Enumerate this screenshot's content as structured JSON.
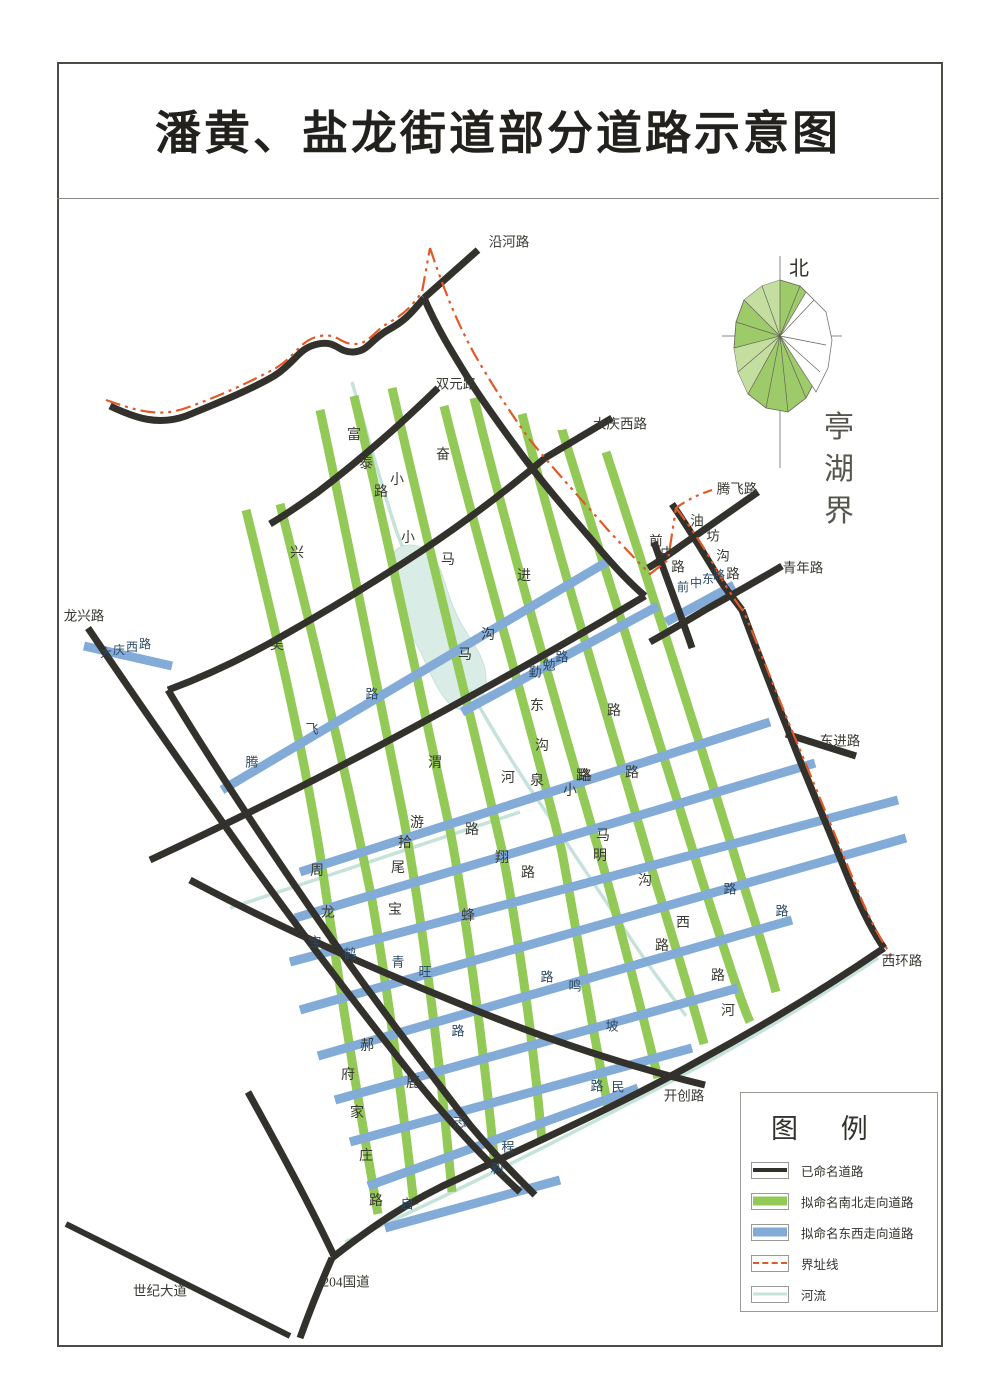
{
  "title": "潘黄、盐龙街道部分道路示意图",
  "compass": {
    "north_label": "北"
  },
  "colors": {
    "road_named": "#33312c",
    "road_ns": "#92c957",
    "road_ew": "#82abd8",
    "boundary": "#e05a28",
    "river": "#c6e3da",
    "river_fill": "#d9ece5",
    "compass_green": "#9ecb6a",
    "label_dark": "#3a3a33",
    "label_blue": "#2c4a66"
  },
  "legend": {
    "title": "图  例",
    "items": [
      {
        "label": "已命名道路",
        "type": "named"
      },
      {
        "label": "拟命名南北走向道路",
        "type": "ns"
      },
      {
        "label": "拟命名东西走向道路",
        "type": "ew"
      },
      {
        "label": "界址线",
        "type": "boundary"
      },
      {
        "label": "河流",
        "type": "river"
      }
    ]
  },
  "map_labels": [
    {
      "t": "沿河路",
      "cls": "road-black",
      "x": 509,
      "y": 242
    },
    {
      "t": "双元路",
      "cls": "road-black",
      "x": 456,
      "y": 384
    },
    {
      "t": "大庆西路",
      "cls": "road-black",
      "x": 620,
      "y": 424
    },
    {
      "t": "腾飞路",
      "cls": "road-black",
      "x": 737,
      "y": 489
    },
    {
      "t": "青年路",
      "cls": "road-black",
      "x": 803,
      "y": 568
    },
    {
      "t": "东进路",
      "cls": "road-black",
      "x": 840,
      "y": 741
    },
    {
      "t": "西环路",
      "cls": "road-black",
      "x": 902,
      "y": 961
    },
    {
      "t": "开创路",
      "cls": "road-black",
      "x": 684,
      "y": 1096
    },
    {
      "t": "龙兴路",
      "cls": "road-black",
      "x": 84,
      "y": 616
    },
    {
      "t": "世纪大道",
      "cls": "road-black",
      "x": 160,
      "y": 1291
    },
    {
      "t": "204国道",
      "cls": "road-black",
      "x": 346,
      "y": 1282
    },
    {
      "t": "亭湖界",
      "cls": "boundary-name",
      "chars": [
        [
          839,
          428
        ],
        [
          839,
          470
        ],
        [
          839,
          512
        ]
      ]
    },
    {
      "t": "油坊沟路",
      "cls": "road-black",
      "chars": [
        [
          697,
          521
        ],
        [
          713,
          536
        ],
        [
          723,
          556
        ],
        [
          733,
          574
        ]
      ]
    },
    {
      "t": "前中路",
      "cls": "road-black",
      "chars": [
        [
          656,
          541
        ],
        [
          667,
          553
        ],
        [
          678,
          567
        ]
      ]
    },
    {
      "t": "富泰路",
      "cls": "road-green",
      "chars": [
        [
          354,
          436
        ],
        [
          366,
          465
        ],
        [
          381,
          493
        ]
      ]
    },
    {
      "t": "奋进路",
      "cls": "road-green",
      "chars": [
        [
          443,
          456
        ],
        [
          524,
          577
        ],
        [
          614,
          712
        ]
      ]
    },
    {
      "t": "小马沟东路",
      "cls": "road-green",
      "chars": [
        [
          397,
          481
        ],
        [
          448,
          561
        ],
        [
          488,
          636
        ],
        [
          537,
          707
        ],
        [
          583,
          777
        ]
      ]
    },
    {
      "t": "周龙",
      "cls": "road-green",
      "chars": [
        [
          317,
          872
        ],
        [
          328,
          914
        ]
      ]
    },
    {
      "t": "马明沟西路",
      "cls": "road-green",
      "chars": [
        [
          603,
          837
        ],
        [
          600,
          857
        ],
        [
          645,
          882
        ],
        [
          683,
          924
        ],
        [
          718,
          977
        ]
      ]
    },
    {
      "t": "郝府家庄路",
      "cls": "road-green",
      "chars": [
        [
          367,
          1047
        ],
        [
          348,
          1076
        ],
        [
          357,
          1114
        ],
        [
          366,
          1157
        ],
        [
          376,
          1202
        ]
      ]
    },
    {
      "t": "兴",
      "cls": "road-green",
      "x": 297,
      "y": 554
    },
    {
      "t": "吴",
      "cls": "road-green",
      "x": 277,
      "y": 646
    },
    {
      "t": "小",
      "cls": "road-green",
      "x": 408,
      "y": 539
    },
    {
      "t": "马",
      "cls": "road-green",
      "x": 465,
      "y": 656
    },
    {
      "t": "沟",
      "cls": "road-green",
      "x": 542,
      "y": 747
    },
    {
      "t": "渭",
      "cls": "road-green",
      "x": 435,
      "y": 764
    },
    {
      "t": "游",
      "cls": "road-green",
      "x": 417,
      "y": 824
    },
    {
      "t": "拾",
      "cls": "road-green",
      "x": 405,
      "y": 844
    },
    {
      "t": "尾",
      "cls": "road-green",
      "x": 398,
      "y": 869
    },
    {
      "t": "翔",
      "cls": "road-green",
      "x": 502,
      "y": 859
    },
    {
      "t": "路",
      "cls": "road-green",
      "x": 472,
      "y": 831
    },
    {
      "t": "路",
      "cls": "road-green",
      "x": 528,
      "y": 874
    },
    {
      "t": "路",
      "cls": "road-green",
      "x": 585,
      "y": 777
    },
    {
      "t": "路",
      "cls": "road-green",
      "x": 632,
      "y": 774
    },
    {
      "t": "小",
      "cls": "road-green",
      "x": 570,
      "y": 792
    },
    {
      "t": "泉",
      "cls": "road-green",
      "x": 537,
      "y": 782
    },
    {
      "t": "河",
      "cls": "road-green",
      "x": 508,
      "y": 779
    },
    {
      "t": "宝",
      "cls": "road-green",
      "x": 395,
      "y": 911
    },
    {
      "t": "蜂",
      "cls": "road-green",
      "x": 468,
      "y": 917
    },
    {
      "t": "鹿",
      "cls": "road-green",
      "x": 413,
      "y": 1084
    },
    {
      "t": "路",
      "cls": "road-green",
      "x": 662,
      "y": 947
    },
    {
      "t": "河",
      "cls": "road-green",
      "x": 728,
      "y": 1012
    },
    {
      "t": "大庆西路",
      "cls": "road-blue-sm",
      "chars": [
        [
          106,
          653
        ],
        [
          119,
          650
        ],
        [
          132,
          647
        ],
        [
          145,
          644
        ]
      ]
    },
    {
      "t": "腾飞路",
      "cls": "road-blue",
      "chars": [
        [
          252,
          762
        ],
        [
          312,
          729
        ],
        [
          372,
          694
        ]
      ]
    },
    {
      "t": "勤勉路",
      "cls": "road-blue",
      "chars": [
        [
          535,
          672
        ],
        [
          549,
          665
        ],
        [
          562,
          657
        ]
      ]
    },
    {
      "t": "前中东路",
      "cls": "road-blue-sm",
      "chars": [
        [
          683,
          587
        ],
        [
          696,
          583
        ],
        [
          708,
          579
        ],
        [
          719,
          575
        ]
      ]
    },
    {
      "t": "宝",
      "cls": "road-blue",
      "x": 315,
      "y": 942
    },
    {
      "t": "鹤",
      "cls": "road-blue",
      "x": 350,
      "y": 954
    },
    {
      "t": "青",
      "cls": "road-blue",
      "x": 398,
      "y": 962
    },
    {
      "t": "旺",
      "cls": "road-blue",
      "x": 425,
      "y": 972
    },
    {
      "t": "路",
      "cls": "road-blue",
      "x": 458,
      "y": 1031
    },
    {
      "t": "路",
      "cls": "road-blue",
      "x": 547,
      "y": 977
    },
    {
      "t": "鸣",
      "cls": "road-blue",
      "x": 575,
      "y": 986
    },
    {
      "t": "坡",
      "cls": "road-blue",
      "x": 612,
      "y": 1026
    },
    {
      "t": "路",
      "cls": "road-blue",
      "x": 597,
      "y": 1086
    },
    {
      "t": "民",
      "cls": "road-blue",
      "x": 618,
      "y": 1087
    },
    {
      "t": "志",
      "cls": "road-blue",
      "x": 460,
      "y": 1122
    },
    {
      "t": "程",
      "cls": "road-blue",
      "x": 508,
      "y": 1147
    },
    {
      "t": "利",
      "cls": "road-blue",
      "x": 497,
      "y": 1169
    },
    {
      "t": "启",
      "cls": "road-blue",
      "x": 407,
      "y": 1204
    },
    {
      "t": "路",
      "cls": "road-blue",
      "x": 730,
      "y": 889
    },
    {
      "t": "路",
      "cls": "road-blue",
      "x": 782,
      "y": 911
    }
  ]
}
